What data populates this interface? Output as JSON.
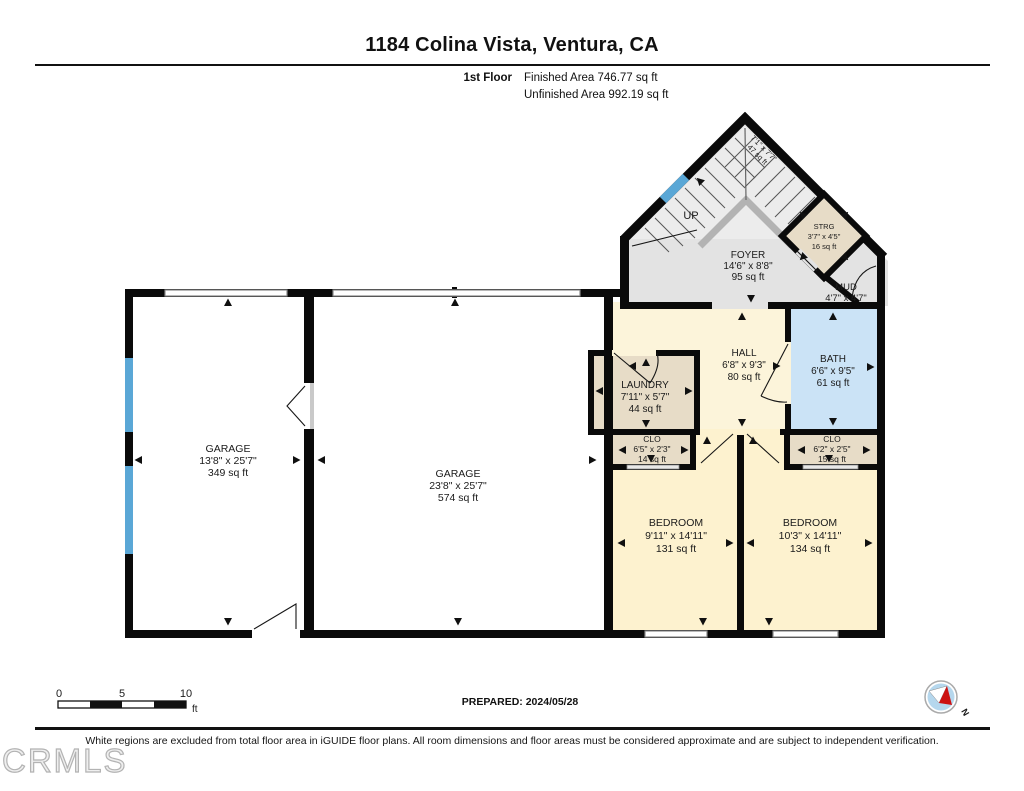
{
  "header": {
    "title": "1184 Colina Vista, Ventura, CA",
    "floor_label": "1st Floor",
    "finished": "Finished Area 746.77 sq ft",
    "unfinished": "Unfinished Area 992.19 sq ft"
  },
  "rooms": {
    "garage_left": {
      "name": "GARAGE",
      "dims": "13'8\" x 25'7\"",
      "area": "349 sq ft"
    },
    "garage_right": {
      "name": "GARAGE",
      "dims": "23'8\" x 25'7\"",
      "area": "574 sq ft"
    },
    "foyer": {
      "name": "FOYER",
      "dims": "14'6\" x 8'8\"",
      "area": "95 sq ft"
    },
    "stairs": {
      "dims": "7'1\" x 7'7\"",
      "area": "47 sq ft",
      "direction": "UP"
    },
    "strg": {
      "name": "STRG",
      "dims": "3'7\" x 4'5\"",
      "area": "16 sq ft"
    },
    "mud": {
      "name": "MUD",
      "dims": "4'7\" x 4'7\""
    },
    "hall": {
      "name": "HALL",
      "dims": "6'8\" x 9'3\"",
      "area": "80 sq ft"
    },
    "laundry": {
      "name": "LAUNDRY",
      "dims": "7'11\" x 5'7\"",
      "area": "44 sq ft"
    },
    "bath": {
      "name": "BATH",
      "dims": "6'6\" x 9'5\"",
      "area": "61 sq ft"
    },
    "clo_left": {
      "name": "CLO",
      "dims": "6'5\" x 2'3\"",
      "area": "14 sq ft"
    },
    "clo_right": {
      "name": "CLO",
      "dims": "6'2\" x 2'5\"",
      "area": "15 sq ft"
    },
    "bedroom_left": {
      "name": "BEDROOM",
      "dims": "9'11\" x 14'11\"",
      "area": "131 sq ft"
    },
    "bedroom_right": {
      "name": "BEDROOM",
      "dims": "10'3\" x 14'11\"",
      "area": "134 sq ft"
    }
  },
  "footer": {
    "prepared": "PREPARED: 2024/05/28",
    "scale": {
      "t0": "0",
      "t5": "5",
      "t10": "10",
      "unit": "ft"
    },
    "disclaimer": "White regions are excluded from total floor area in iGUIDE floor plans. All room dimensions and floor areas must be considered approximate and are subject to independent verification.",
    "watermark": "CRMLS",
    "compass_n": "N"
  },
  "colors": {
    "finished_cream": "#fdf2cf",
    "hall_cream": "#fcf4da",
    "closet_tan": "#e7dcc7",
    "bath_blue": "#cbe3f6",
    "foyer_gray": "#e3e3e3",
    "stair_gray": "#ececec",
    "window_blue": "#5aa7d6",
    "wall": "#0a0a0a"
  }
}
